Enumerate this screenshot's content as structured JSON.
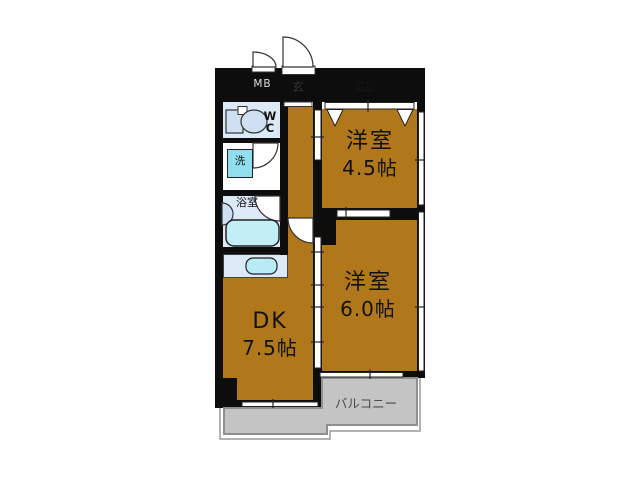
{
  "plan_type": "apartment-floor-plan",
  "rooms": {
    "western_45": {
      "name": "洋室",
      "size": "4.5帖"
    },
    "western_60": {
      "name": "洋室",
      "size": "6.0帖"
    },
    "dk": {
      "name": "DK",
      "size": "7.5帖"
    },
    "balcony": {
      "label": "バルコニー"
    },
    "entrance": {
      "label": "玄"
    },
    "closet": {
      "label": "CL"
    },
    "meter_box": {
      "label": "MB"
    },
    "wc": {
      "line1": "W",
      "line2": "C"
    },
    "laundry": {
      "label": "洗"
    },
    "bathroom": {
      "label": "浴室"
    }
  },
  "colors": {
    "room_floor": "#b0781a",
    "closet_floor": "#8a6f1a",
    "meter_box": "#4d8180",
    "entrance_floor": "#c9c9c9",
    "wet_room": "#dce9f6",
    "fixture": "#cfe0f2",
    "washer": "#90dfee",
    "bathtub": "#c2eef6",
    "sink": "#b8ebf3",
    "balcony": "#c4c4c4",
    "wall": "#0d0d0d"
  }
}
